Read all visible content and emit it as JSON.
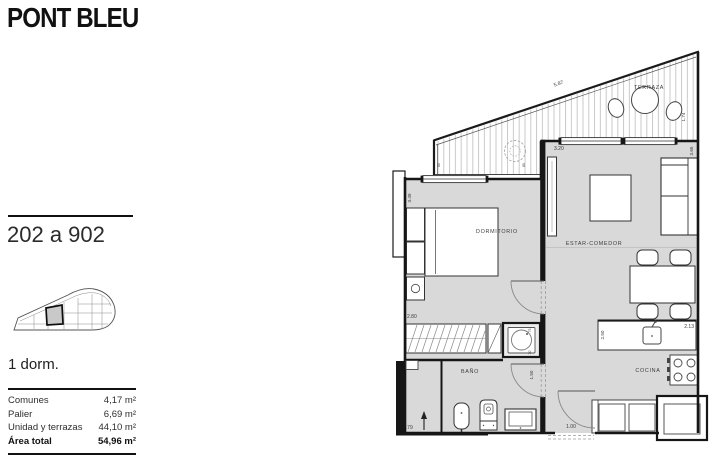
{
  "header": {
    "title": "PONT BLEU"
  },
  "sidebar": {
    "unit_range": "202 a 902",
    "unit_type": "1 dorm.",
    "area_table": {
      "rows": [
        {
          "label": "Comunes",
          "value": "4,17 m²",
          "bold": false
        },
        {
          "label": "Palier",
          "value": "6,69 m²",
          "bold": false
        },
        {
          "label": "Unidad y terrazas",
          "value": "44,10 m²",
          "bold": false
        },
        {
          "label": "Área total",
          "value": "54,96 m²",
          "bold": true
        }
      ]
    }
  },
  "plan": {
    "room_labels": {
      "terraza": "TERRAZA",
      "dormitorio": "DORMITORIO",
      "estar_comedor": "ESTAR-COMEDOR",
      "bano": "BAÑO",
      "cocina": "COCINA"
    },
    "dimensions": {
      "terrace_length": "5.87",
      "terrace_depth": "1.74",
      "parapet_left": "80",
      "parapet_right": "80",
      "living_width": "3.20",
      "living_depth": "3.65",
      "bedroom_depth": "3.49",
      "bedroom_width": "2.80",
      "bath_width": "2.79",
      "hall_door": "1.50",
      "kitchen_depth": "2.50",
      "kitchen_width": "2.13",
      "entry_width": "1.00",
      "shower_w": ".75",
      "shower_d": ".70"
    },
    "colors": {
      "room_fill": "#d9d9d9",
      "wall": "#1a1a1a",
      "hatch": "#c4c4c4"
    }
  }
}
